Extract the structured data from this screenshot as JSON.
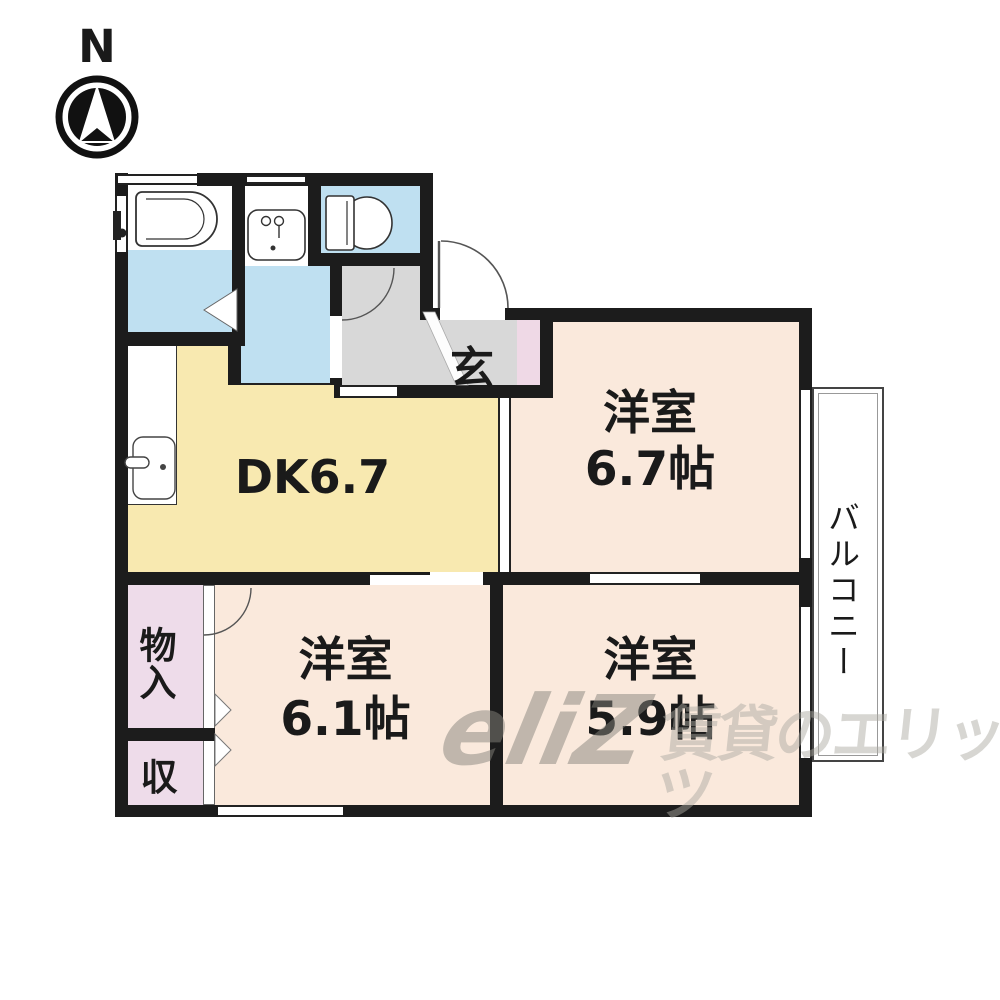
{
  "compass": {
    "label": "N"
  },
  "rooms": {
    "dk": {
      "label": "DK6.7"
    },
    "western1": {
      "name": "洋室",
      "size": "6.7帖"
    },
    "western2": {
      "name": "洋室",
      "size": "6.1帖"
    },
    "western3": {
      "name": "洋室",
      "size": "5.9帖"
    },
    "entrance": {
      "label": "玄"
    },
    "storage_monoire": {
      "label": "物入"
    },
    "storage_shu": {
      "label": "収"
    },
    "balcony": {
      "label": "バルコニー"
    }
  },
  "watermark": {
    "logo": "eliZ",
    "text": "賃貸のエリッツ"
  },
  "colors": {
    "wall": "#1c1c1c",
    "line": "#555555",
    "water_blue": "#bfe0f1",
    "dk_yellow": "#f8e9b0",
    "room_peach": "#fae9dc",
    "hall_gray": "#d8d8d8",
    "closet_pink": "#eedcea",
    "genkan_pink": "#efd9e6"
  }
}
